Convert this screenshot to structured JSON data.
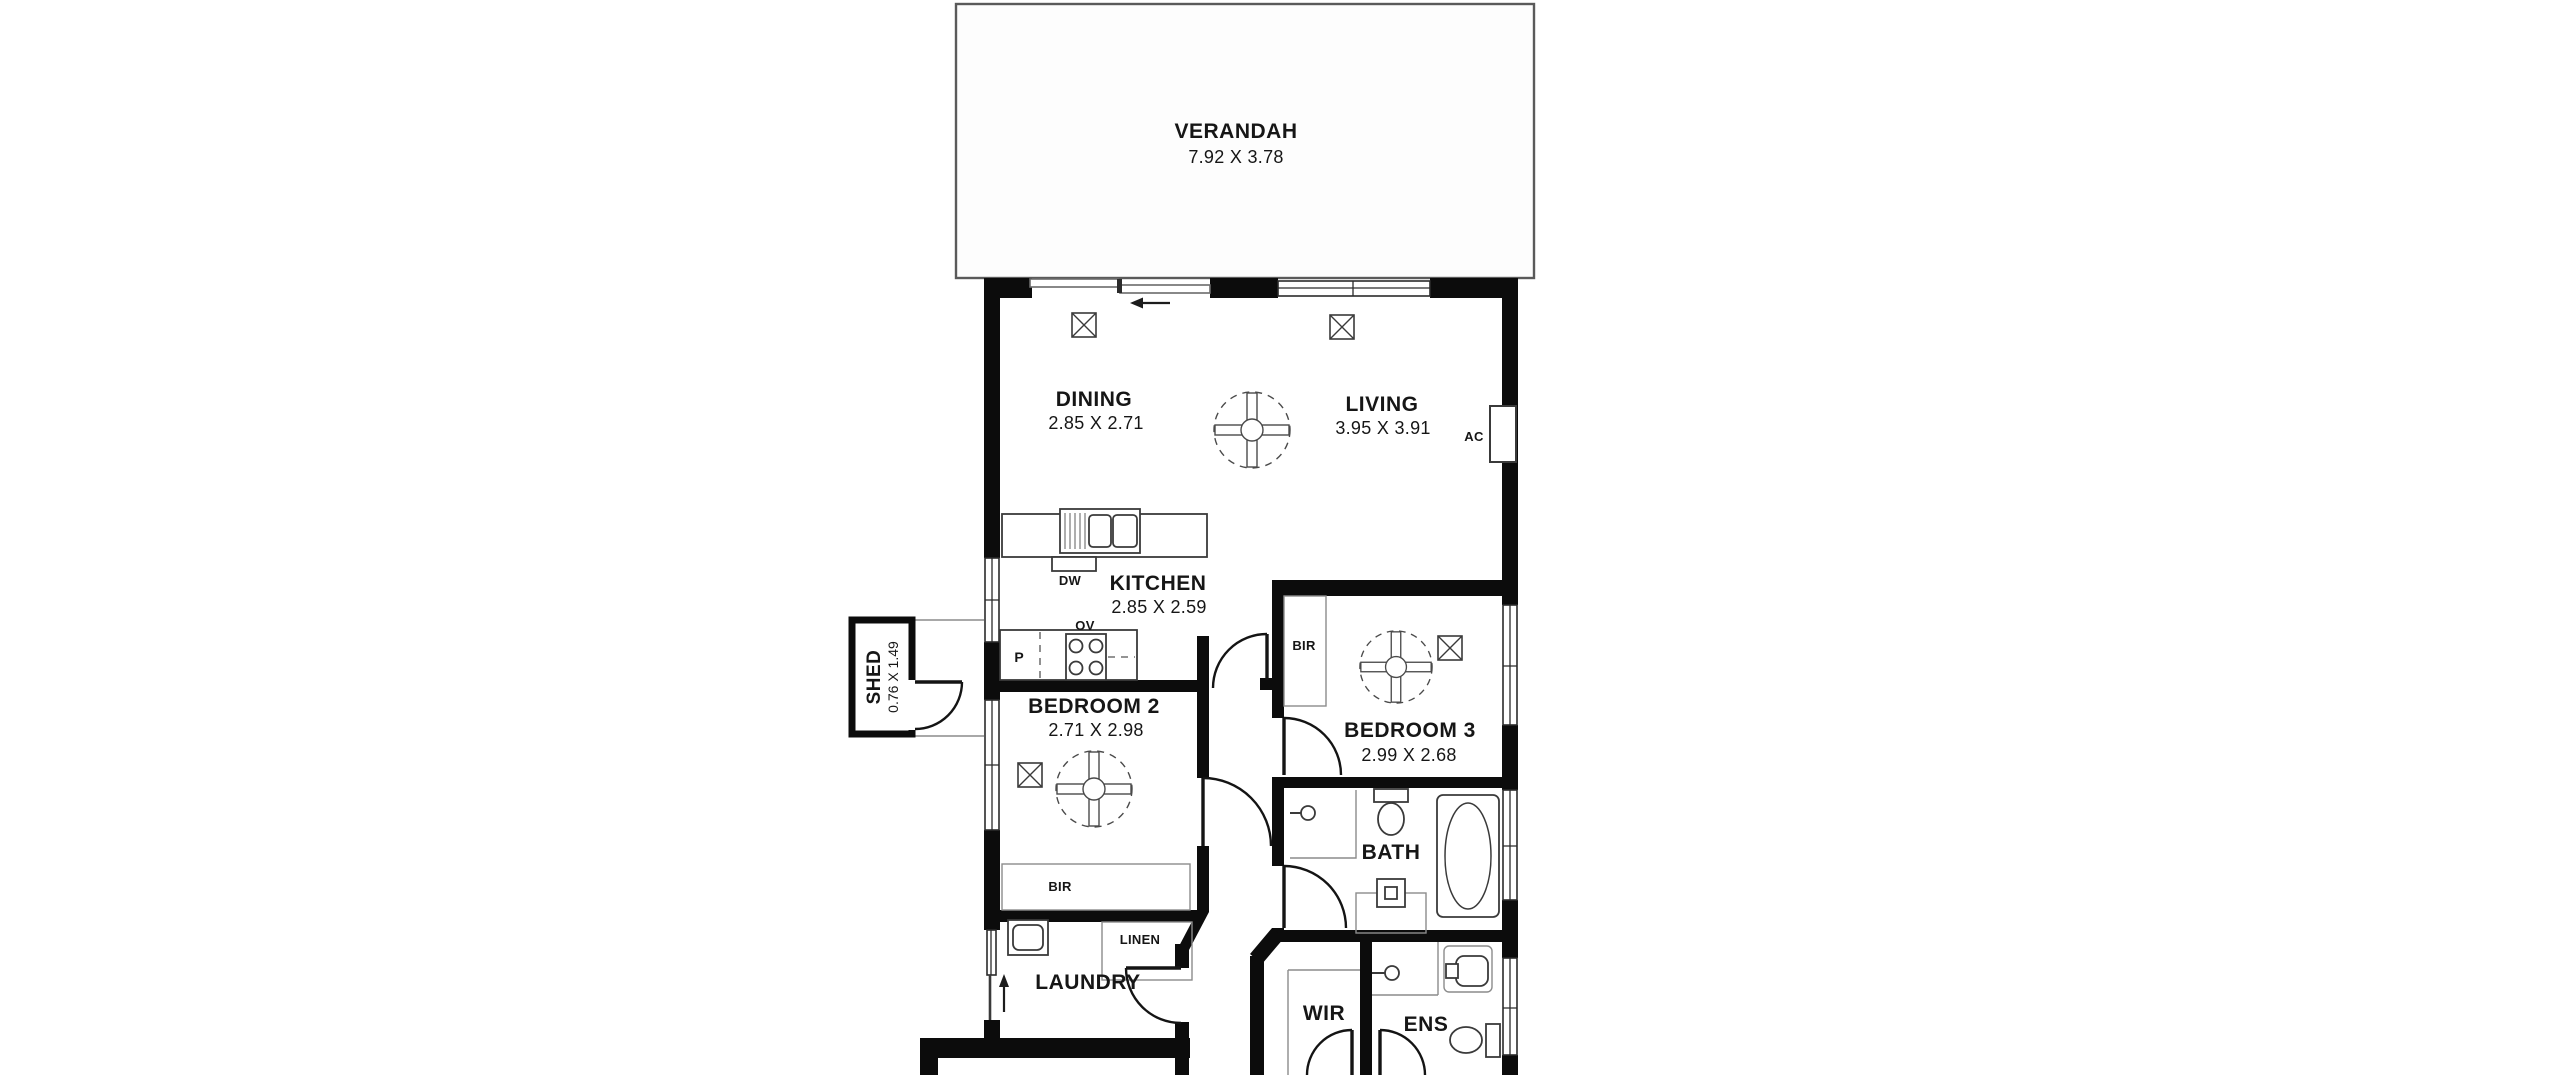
{
  "canvas": {
    "width": 2560,
    "height": 1075
  },
  "colors": {
    "background": "#ffffff",
    "wall": "#0c0c0c",
    "fixture_line": "#3a3a3a",
    "thin_line": "#8c8c8c",
    "text": "#161616",
    "verandah_border": "#5a5a5a",
    "verandah_fill": "#fdfdfd"
  },
  "rooms": {
    "verandah": {
      "label": "VERANDAH",
      "dims": "7.92 X 3.78"
    },
    "dining": {
      "label": "DINING",
      "dims": "2.85 X 2.71"
    },
    "living": {
      "label": "LIVING",
      "dims": "3.95 X 3.91"
    },
    "kitchen": {
      "label": "KITCHEN",
      "dims": "2.85 X 2.59"
    },
    "bedroom2": {
      "label": "BEDROOM 2",
      "dims": "2.71 X 2.98"
    },
    "bedroom3": {
      "label": "BEDROOM 3",
      "dims": "2.99 X 2.68"
    },
    "bath": {
      "label": "BATH"
    },
    "laundry": {
      "label": "LAUNDRY"
    },
    "wir": {
      "label": "WIR"
    },
    "ens": {
      "label": "ENS"
    },
    "shed": {
      "label": "SHED",
      "dims": "0.76 X 1.49"
    }
  },
  "fixture_labels": {
    "dishwasher": "DW",
    "oven": "OV",
    "pantry": "P",
    "robe_bedroom2": "BIR",
    "robe_bedroom3": "BIR",
    "linen": "LINEN",
    "aircon": "AC"
  }
}
